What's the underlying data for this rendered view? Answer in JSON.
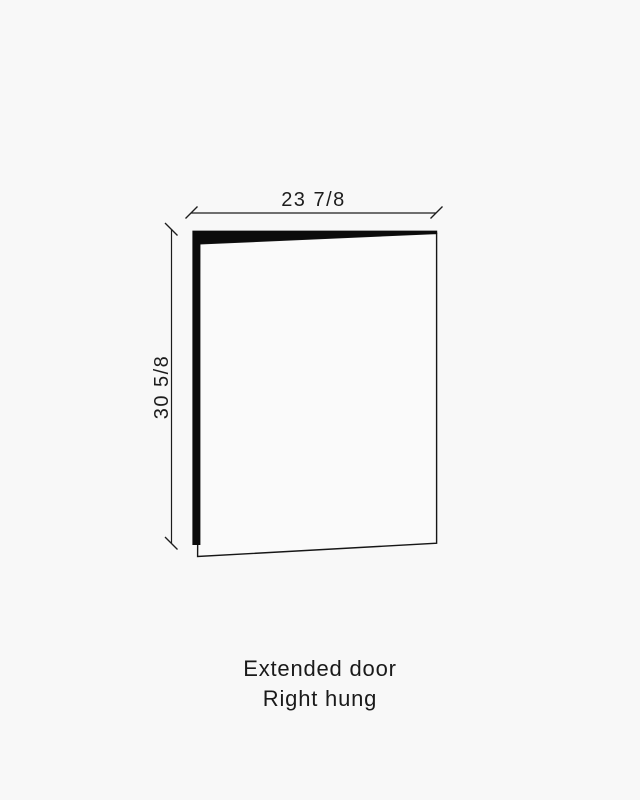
{
  "diagram": {
    "type": "cabinet-door-dimension-drawing",
    "width_label": "23 7/8",
    "height_label": "30 5/8"
  },
  "caption": {
    "line1": "Extended door",
    "line2": "Right hung"
  },
  "colors": {
    "background": "#f8f8f8",
    "line": "#1d1d1d",
    "door_edge_fill": "#0b0b0b",
    "door_face_fill": "#fafafa",
    "text": "#1a1a1a"
  }
}
